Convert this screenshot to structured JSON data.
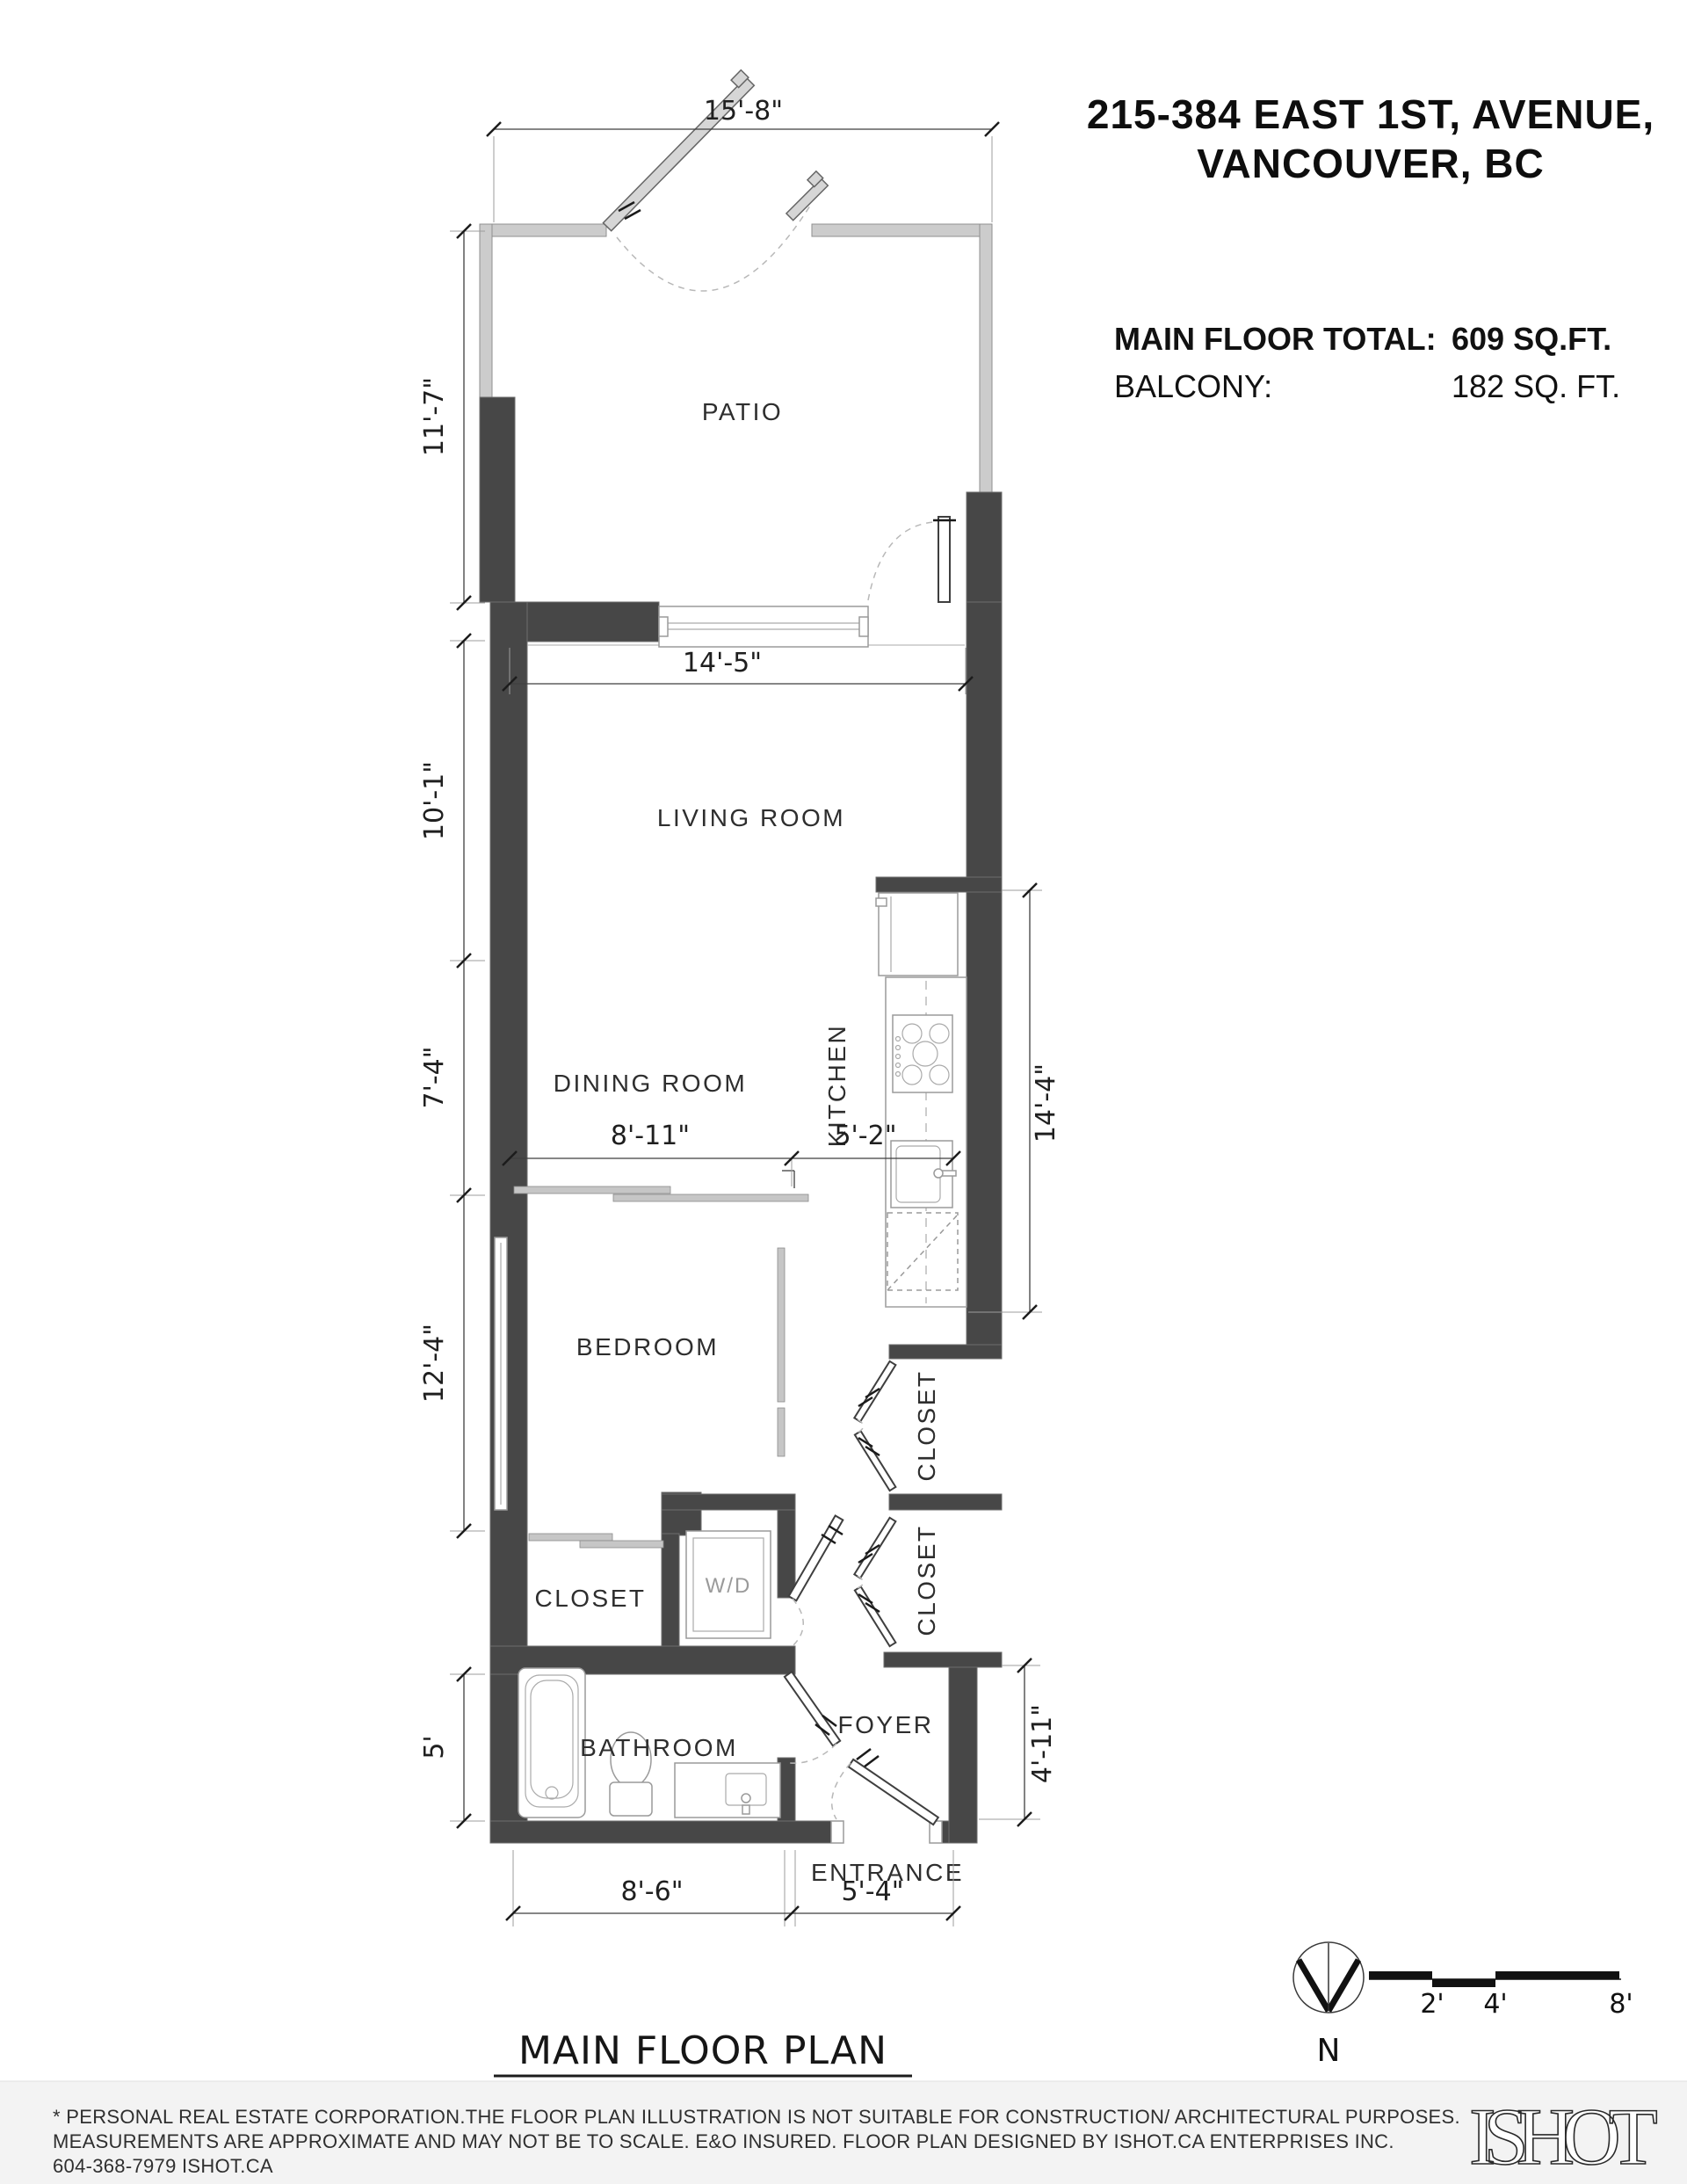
{
  "header": {
    "address_line1": "215-384 EAST 1ST, AVENUE,",
    "address_line2": "VANCOUVER, BC",
    "stats": [
      {
        "label": "MAIN FLOOR TOTAL:",
        "value": "609 SQ.FT."
      },
      {
        "label": "BALCONY:",
        "value": "182 SQ. FT."
      }
    ]
  },
  "rooms": {
    "patio": "PATIO",
    "living": "LIVING ROOM",
    "dining": "DINING ROOM",
    "kitchen": "KITCHEN",
    "bedroom": "BEDROOM",
    "closet_bedroom": "CLOSET",
    "wd": "W/D",
    "closet_upper": "CLOSET",
    "closet_lower": "CLOSET",
    "bathroom": "BATHROOM",
    "foyer": "FOYER",
    "entrance": "ENTRANCE"
  },
  "dimensions": {
    "patio_width": "15'-8\"",
    "patio_depth": "11'-7\"",
    "living_width": "14'-5\"",
    "living_depth": "10'-1\"",
    "dining_depth": "7'-4\"",
    "dining_width": "8'-11\"",
    "kitchen_width": "5'-2\"",
    "kitchen_length": "14'-4\"",
    "bedroom_depth": "12'-4\"",
    "bathroom_depth": "5'",
    "foyer_depth": "4'-11\"",
    "bathroom_width": "8'-6\"",
    "entrance_width": "5'-4\""
  },
  "plan_footer": {
    "title": "MAIN FLOOR PLAN",
    "ceiling_height": "Ceiling Height: 9'-0\""
  },
  "compass": {
    "north_label": "N"
  },
  "scale_bar": {
    "tick_2": "2'",
    "tick_4": "4'",
    "tick_8": "8'"
  },
  "disclaimer": {
    "line1": "* PERSONAL REAL ESTATE CORPORATION.THE FLOOR PLAN ILLUSTRATION IS NOT SUITABLE FOR CONSTRUCTION/ ARCHITECTURAL PURPOSES.",
    "line2": "MEASUREMENTS ARE APPROXIMATE AND MAY NOT BE TO SCALE. E&O INSURED. FLOOR PLAN DESIGNED BY ISHOT.CA ENTERPRISES INC.",
    "line3": "604-368-7979  ISHOT.CA"
  },
  "branding": {
    "logo_text": "ISHOT"
  },
  "colors": {
    "wall_dark": "#474747",
    "fence_light": "#cccccc",
    "footer_bg": "#f3f3f3",
    "dim_line": "#3f3f3f"
  }
}
